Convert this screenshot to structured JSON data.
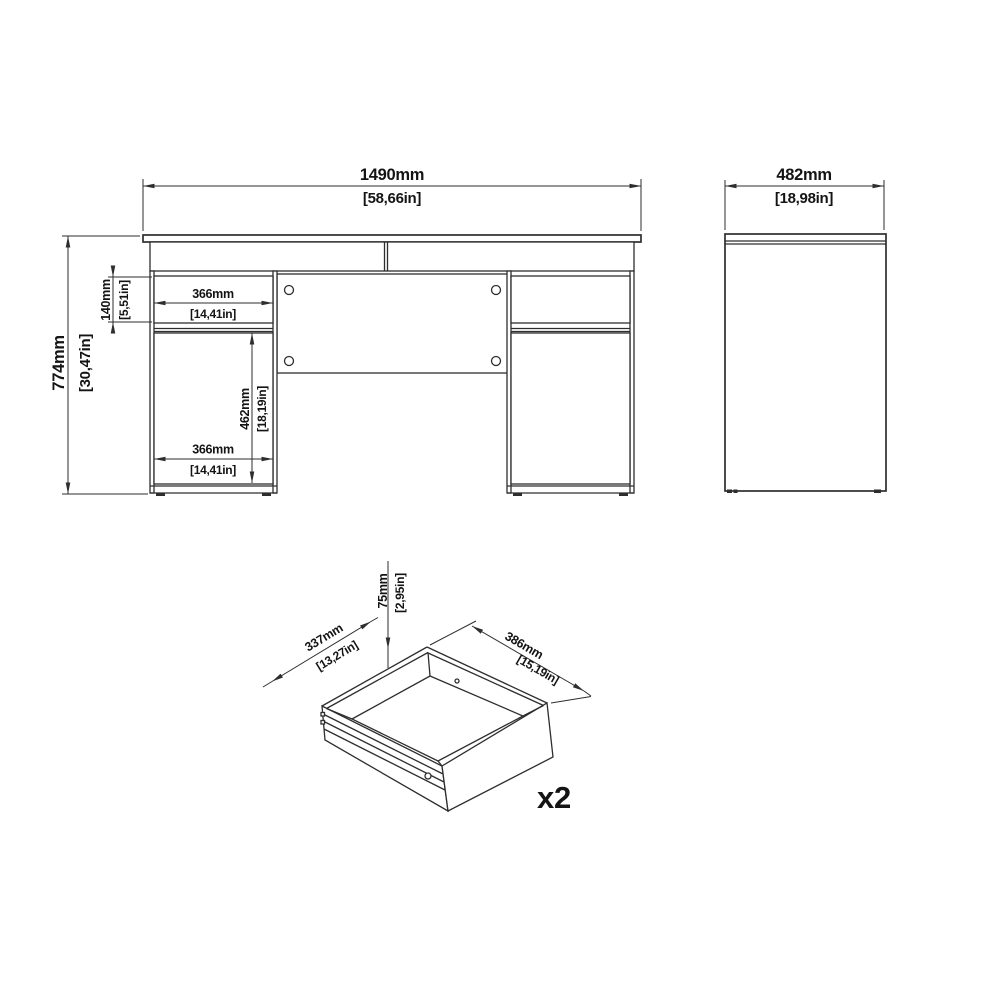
{
  "style": {
    "background": "#ffffff",
    "line_color": "#2e2e2e",
    "text_color": "#141414"
  },
  "front_view": {
    "overall_width": {
      "mm": "1490mm",
      "in": "[58,66in]"
    },
    "overall_height": {
      "mm": "774mm",
      "in": "[30,47in]"
    },
    "top_drawer_height": {
      "mm": "140mm",
      "in": "[5,51in]"
    },
    "top_drawer_width": {
      "mm": "366mm",
      "in": "[14,41in]"
    },
    "door_height": {
      "mm": "462mm",
      "in": "[18,19in]"
    },
    "door_width": {
      "mm": "366mm",
      "in": "[14,41in]"
    }
  },
  "side_view": {
    "overall_depth": {
      "mm": "482mm",
      "in": "[18,98in]"
    }
  },
  "drawer_view": {
    "inner_depth": {
      "mm": "337mm",
      "in": "[13,27in]"
    },
    "inner_height": {
      "mm": "75mm",
      "in": "[2,95in]"
    },
    "inner_width": {
      "mm": "386mm",
      "in": "[15,19in]"
    },
    "quantity_label": "x2"
  }
}
